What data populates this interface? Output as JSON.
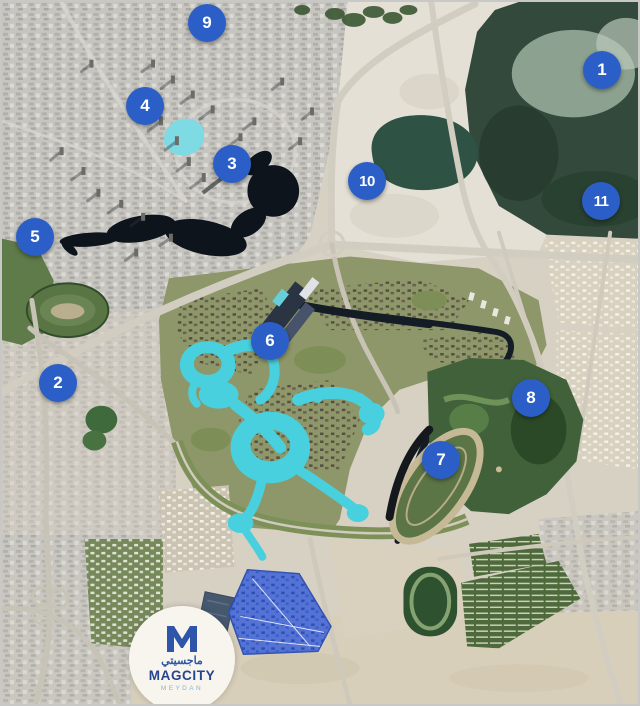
{
  "map": {
    "description": "Aerial satellite map of the Meydan / Downtown Dubai area with numbered location markers",
    "marker_color": "#2b5fc7",
    "marker_text_color": "#ffffff",
    "markers": [
      {
        "label": "1",
        "x": 600,
        "y": 68
      },
      {
        "label": "2",
        "x": 56,
        "y": 381
      },
      {
        "label": "3",
        "x": 230,
        "y": 162
      },
      {
        "label": "4",
        "x": 143,
        "y": 104
      },
      {
        "label": "5",
        "x": 33,
        "y": 235
      },
      {
        "label": "6",
        "x": 268,
        "y": 339
      },
      {
        "label": "7",
        "x": 439,
        "y": 458
      },
      {
        "label": "8",
        "x": 529,
        "y": 396
      },
      {
        "label": "9",
        "x": 205,
        "y": 21
      },
      {
        "label": "10",
        "x": 365,
        "y": 179
      },
      {
        "label": "11",
        "x": 599,
        "y": 199
      }
    ]
  },
  "logo": {
    "monogram": "M",
    "arabic_name": "ماجسيتي",
    "brand_name": "MAGCITY",
    "sub_brand": "MEYDAN",
    "monogram_color": "#2d55a9",
    "brand_color": "#27448f",
    "sub_brand_color": "#8fb3cc"
  },
  "palette": {
    "lake_dark": "#0e141b",
    "lagoon_cyan": "#49d0de",
    "sanctuary_green": "#32493b",
    "sand": "#d7d1c3",
    "highlight_district_blue": "#4f6fd6",
    "border": "#c8c8c6"
  }
}
